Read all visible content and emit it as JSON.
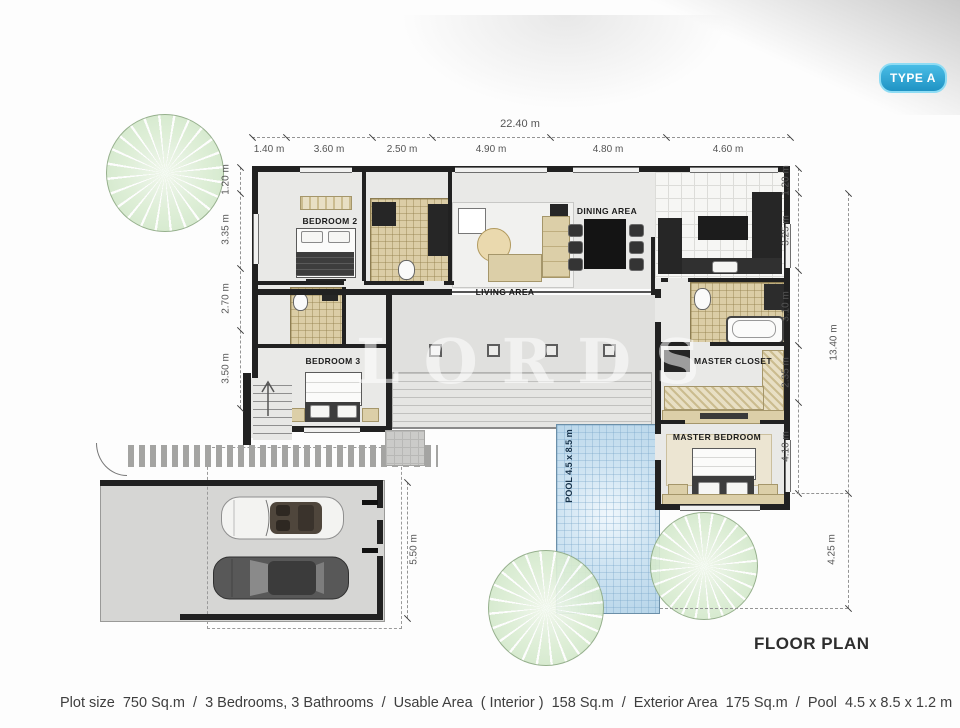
{
  "badge": {
    "label": "TYPE A"
  },
  "plan": {
    "title": "FLOOR PLAN",
    "watermark": "LORDS",
    "rooms": {
      "bedroom2": "BEDROOM 2",
      "bedroom3": "BEDROOM 3",
      "living": "LIVING AREA",
      "dining": "DINING AREA",
      "master_closet": "MASTER CLOSET",
      "master_bedroom": "MASTER BEDROOM",
      "pool": "POOL  4.5 x 8.5 m"
    },
    "dimensions": {
      "top_total": "22.40 m",
      "top_segments": [
        "1.40 m",
        "3.60 m",
        "2.50 m",
        "4.90 m",
        "4.80 m",
        "4.60 m"
      ],
      "left": [
        "1.20 m",
        "3.35 m",
        "2.70 m",
        "3.50 m"
      ],
      "right_inner": [
        "1.20 m",
        "3.25 m",
        "3.10 m",
        "2.35 m",
        "4.10 m"
      ],
      "right_total": "13.40 m",
      "right_lower": "4.25 m",
      "garage": "5.50 m"
    }
  },
  "footer": {
    "specs": "Plot size  750 Sq.m  /  3 Bedrooms, 3 Bathrooms  /  Usable Area  ( Interior )  158 Sq.m  /  Exterior Area  175 Sq.m  /  Pool  4.5 x 8.5 x 1.2 m"
  },
  "colors": {
    "badge_blue": "#2aa9d9",
    "pool_blue": "#c6dff0",
    "wall_dark": "#212121",
    "tile_tan": "#dbcda6",
    "tree_green": "#ddeed6"
  }
}
